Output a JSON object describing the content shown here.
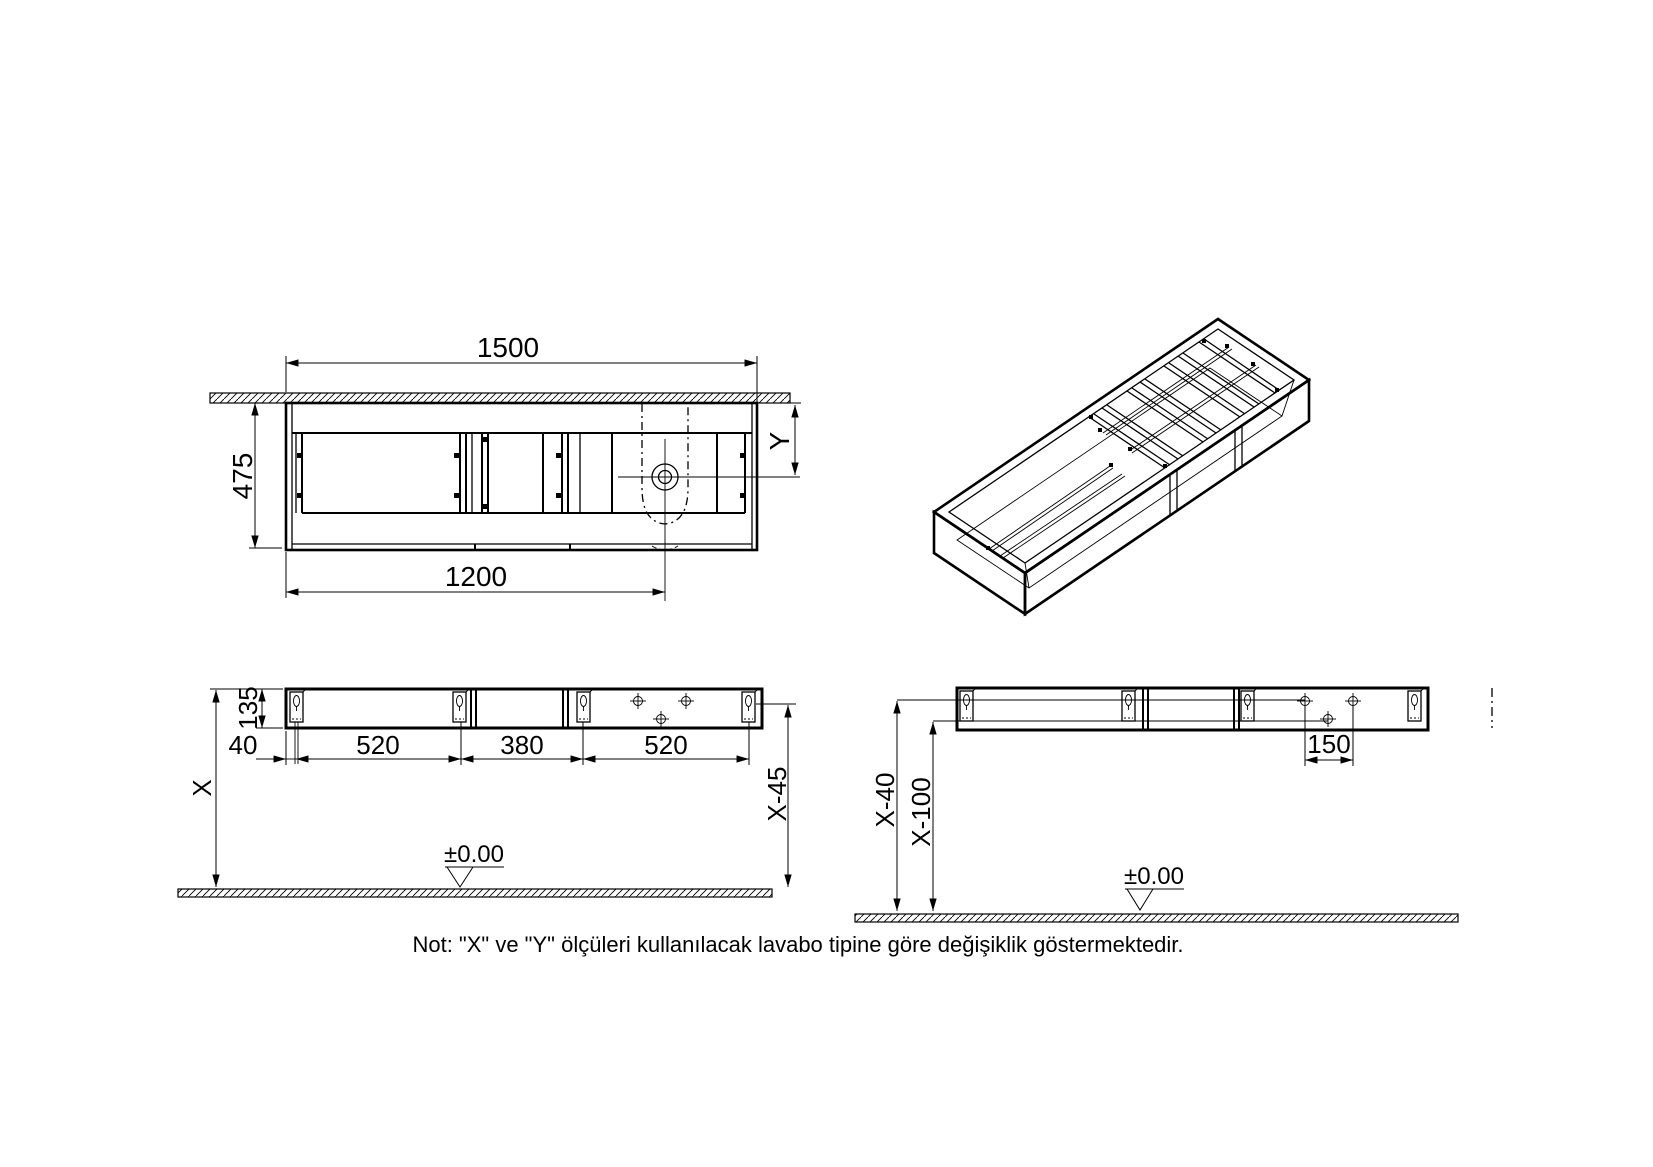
{
  "note": "Not: \"X\" ve \"Y\" ölçüleri kullanılacak lavabo tipine göre değişiklik göstermektedir.",
  "plan_view": {
    "width": "1500",
    "depth": "475",
    "drain_offset": "1200",
    "drain_depth": "Y"
  },
  "elevation_left": {
    "panel_height": "135",
    "edge_to_slot": "40",
    "slot_span_1": "520",
    "slot_span_2": "380",
    "slot_span_3": "520",
    "mount_height": "X",
    "hole_height": "X-45",
    "datum": "±0.00"
  },
  "elevation_right": {
    "slot_hole_height": "X-40",
    "drain_hole_height": "X-100",
    "hole_spacing": "150",
    "datum": "±0.00"
  }
}
